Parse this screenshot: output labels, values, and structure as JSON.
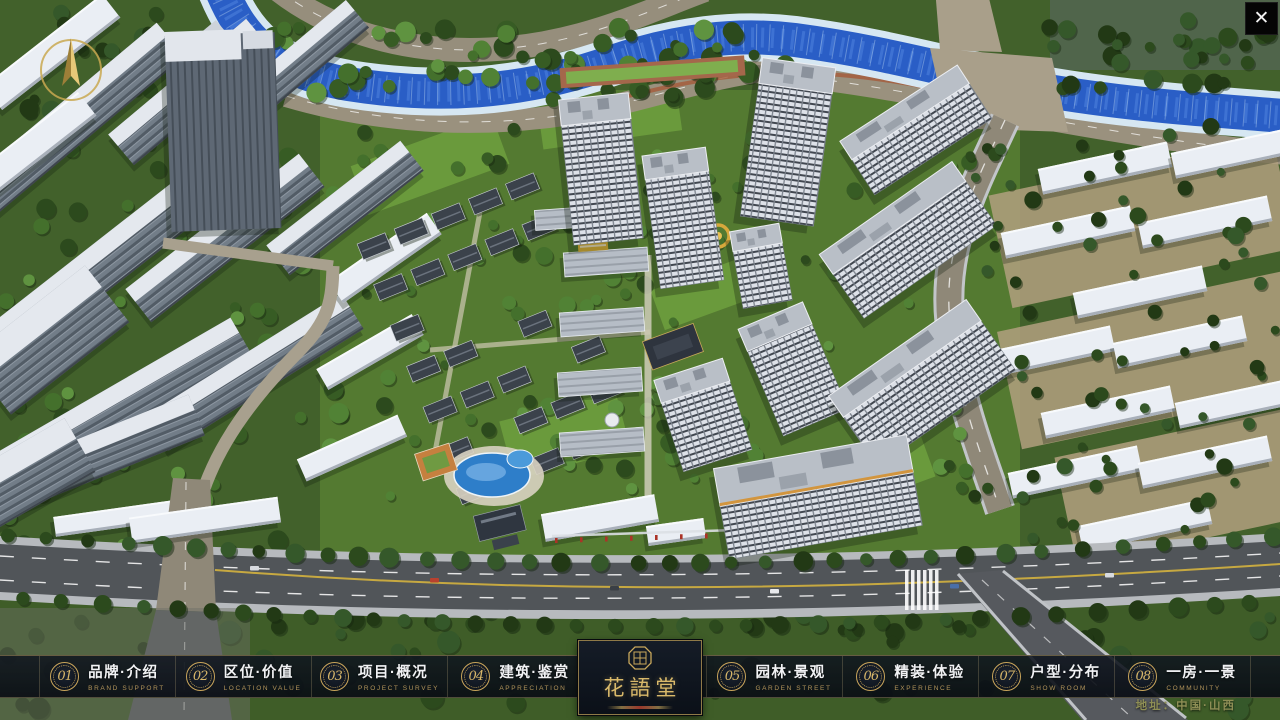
{
  "nav": {
    "items": [
      {
        "num": "01",
        "zh": "品牌·介绍",
        "en": "BRAND SUPPORT"
      },
      {
        "num": "02",
        "zh": "区位·价值",
        "en": "LOCATION VALUE"
      },
      {
        "num": "03",
        "zh": "项目·概况",
        "en": "PROJECT SURVEY"
      },
      {
        "num": "04",
        "zh": "建筑·鉴赏",
        "en": "APPRECIATION"
      },
      {
        "num": "05",
        "zh": "园林·景观",
        "en": "GARDEN STREET"
      },
      {
        "num": "06",
        "zh": "精装·体验",
        "en": "EXPERIENCE"
      },
      {
        "num": "07",
        "zh": "户型·分布",
        "en": "SHOW ROOM"
      },
      {
        "num": "08",
        "zh": "一房·一景",
        "en": "COMMUNITY"
      }
    ],
    "logo": {
      "title": "花語堂"
    }
  },
  "footer": {
    "address": "地址：中国·山西"
  },
  "icons": {
    "close_glyph": "✕"
  },
  "colors": {
    "accent_gold": "#c9a55b",
    "bar_bg": "#0e141d",
    "river_blue": "#2a5ec6",
    "tree_green": "#375c24"
  }
}
